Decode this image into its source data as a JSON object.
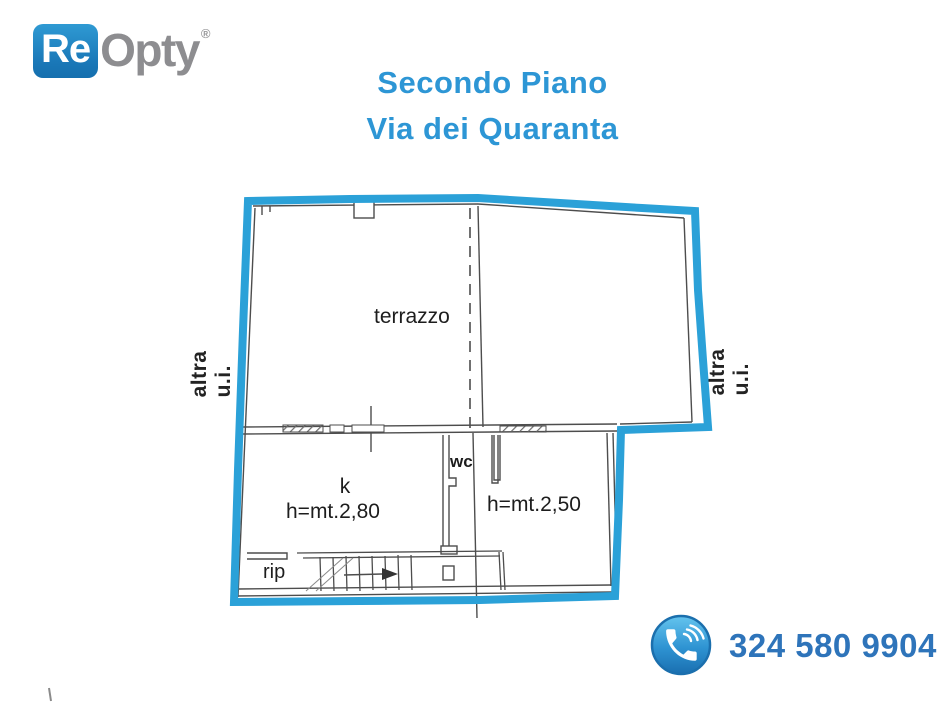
{
  "brand": {
    "name_primary": "Re",
    "name_secondary": "Opty",
    "registered_mark": "®"
  },
  "title": {
    "line1": "Secondo Piano",
    "line2": "Via dei Quaranta"
  },
  "floorplan": {
    "rooms": {
      "terrace": "terrazzo",
      "kitchen": "k",
      "kitchen_height": "h=mt.2,80",
      "wc": "wc",
      "room_height": "h=mt.2,50",
      "storage": "rip"
    },
    "adjacent_left": "altra u.i.",
    "adjacent_right": "altra u.i.",
    "outline_color": "#2ba1d8",
    "wall_color": "#4d4d4d"
  },
  "contact": {
    "phone": "324 580 9904"
  },
  "colors": {
    "title_blue": "#2d96d5",
    "phone_blue": "#2e74ba",
    "logo_blue": "#1e86c6",
    "logo_gray": "#8d8d90"
  }
}
